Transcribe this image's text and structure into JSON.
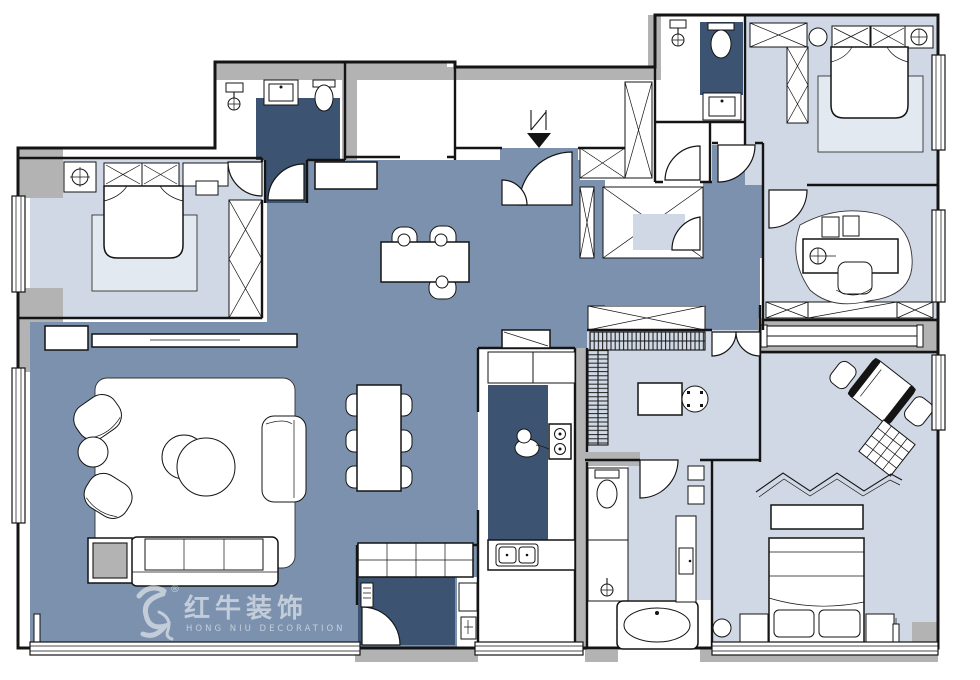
{
  "watermark": {
    "brand_cn": "红牛装饰",
    "brand_en": "HONG NIU DECORATION",
    "registered": "®"
  },
  "palette": {
    "hall": "#7b91ae",
    "room_light": "#cfd8e4",
    "wet_dark": "#3c5472",
    "wall_gray": "#b3b3b3",
    "line": "#141414",
    "rug": "#e3e9f1",
    "watermark_color": "rgba(255,255,255,0.55)"
  }
}
